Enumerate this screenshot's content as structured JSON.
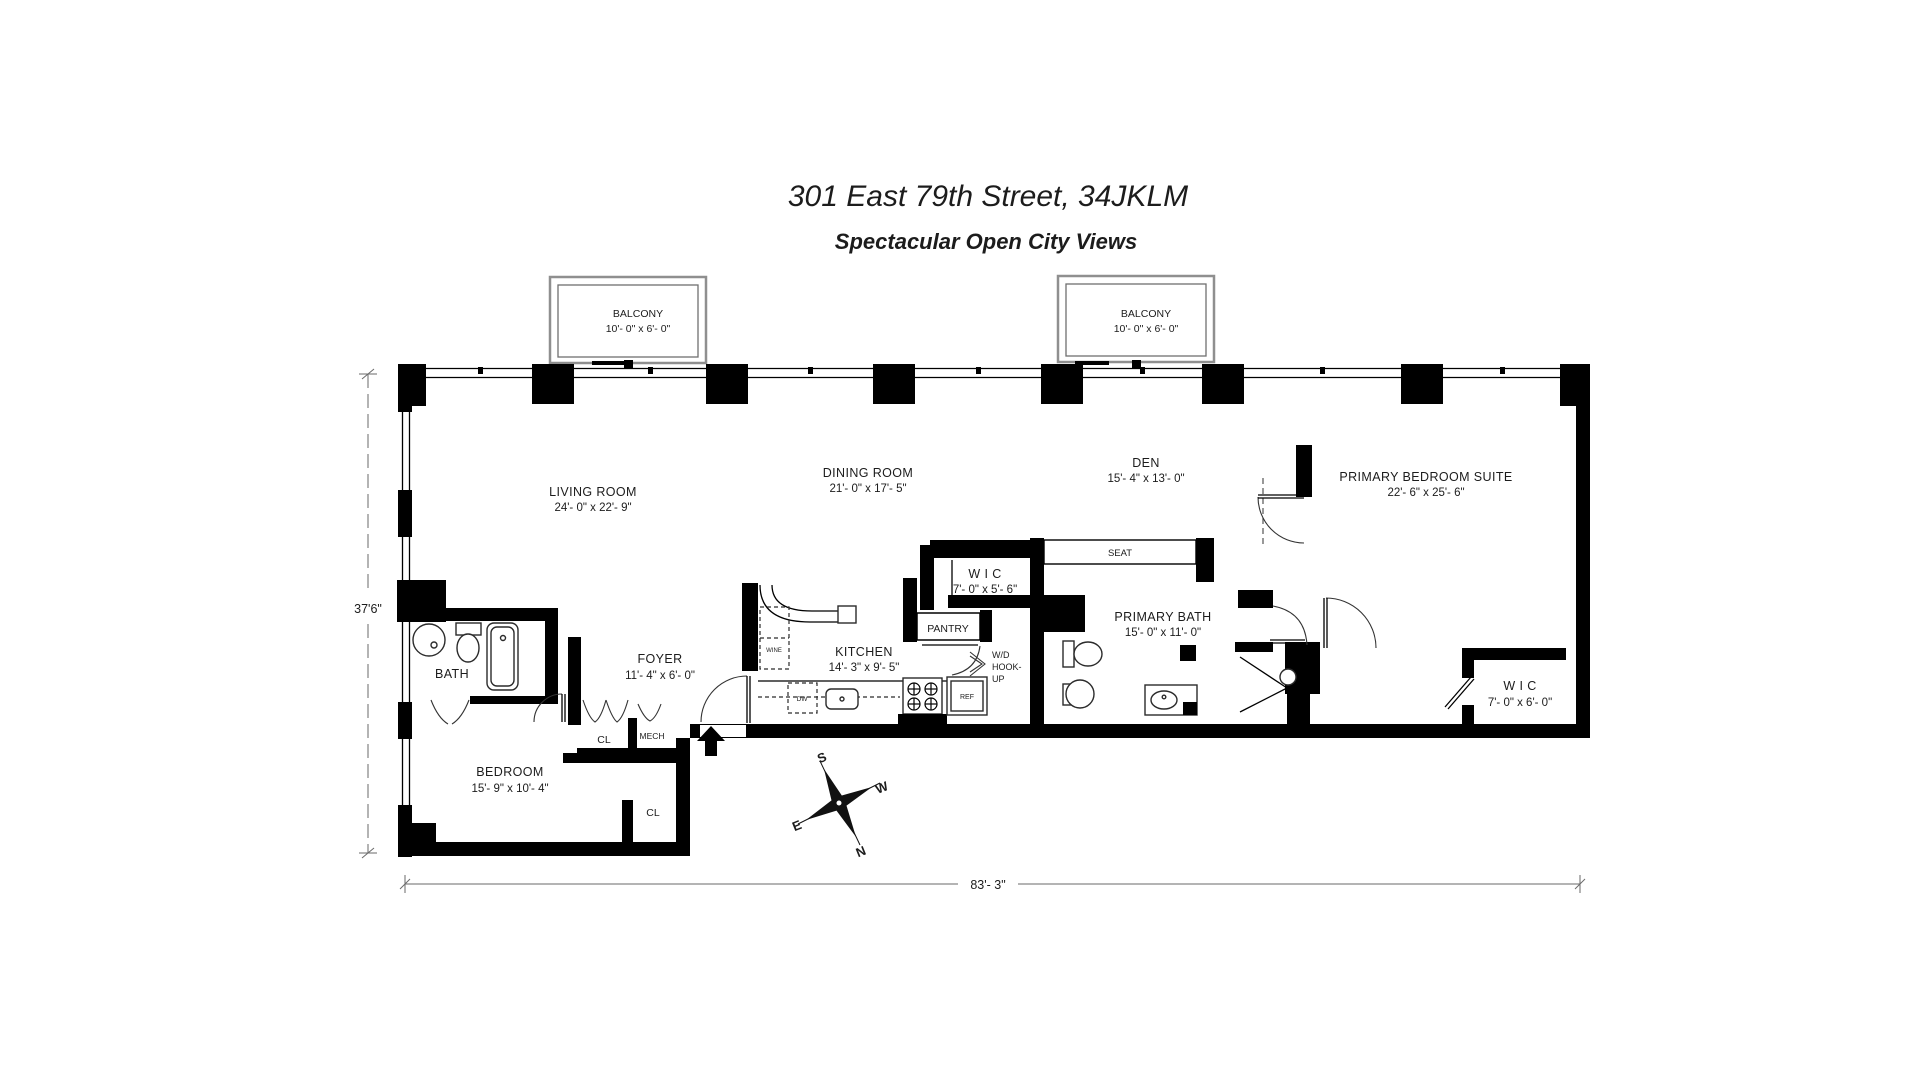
{
  "header": {
    "title": "301 East 79th Street, 34JKLM",
    "subtitle": "Spectacular Open City Views"
  },
  "balconies": [
    {
      "name": "BALCONY",
      "dims": "10'- 0\" x 6'- 0\""
    },
    {
      "name": "BALCONY",
      "dims": "10'- 0\" x 6'- 0\""
    }
  ],
  "rooms": {
    "living": {
      "name": "LIVING ROOM",
      "dims": "24'- 0\" x 22'- 9\""
    },
    "dining": {
      "name": "DINING ROOM",
      "dims": "21'- 0\" x 17'- 5\""
    },
    "den": {
      "name": "DEN",
      "dims": "15'- 4\" x 13'- 0\""
    },
    "suite": {
      "name": "PRIMARY BEDROOM SUITE",
      "dims": "22'- 6\" x 25'- 6\""
    },
    "wic_center": {
      "name": "W I C",
      "dims": "7'- 0\" x 5'- 6\""
    },
    "bath_primary": {
      "name": "PRIMARY BATH",
      "dims": "15'- 0\" x 11'- 0\""
    },
    "wic_right": {
      "name": "W I C",
      "dims": "7'- 0\" x 6'- 0\""
    },
    "kitchen": {
      "name": "KITCHEN",
      "dims": "14'- 3\" x 9'- 5\""
    },
    "foyer": {
      "name": "FOYER",
      "dims": "11'- 4\" x 6'- 0\""
    },
    "bedroom": {
      "name": "BEDROOM",
      "dims": "15'- 9\" x 10'- 4\""
    },
    "bath": {
      "name": "BATH"
    }
  },
  "labels": {
    "seat": "SEAT",
    "pantry": "PANTRY",
    "wd_line1": "W/D",
    "wd_line2": "HOOK-",
    "wd_line3": "UP",
    "cl_foyer": "CL",
    "mech": "MECH",
    "cl_bedroom": "CL",
    "wine": "WINE",
    "dw": "DW",
    "ref": "REF"
  },
  "dimensions": {
    "side_height": "37'6\"",
    "bottom_width": "83'- 3\""
  },
  "compass": {
    "n": "N",
    "s": "S",
    "e": "E",
    "w": "W"
  },
  "colors": {
    "wall": "#000000",
    "text": "#1c1c1c",
    "background": "#ffffff"
  }
}
